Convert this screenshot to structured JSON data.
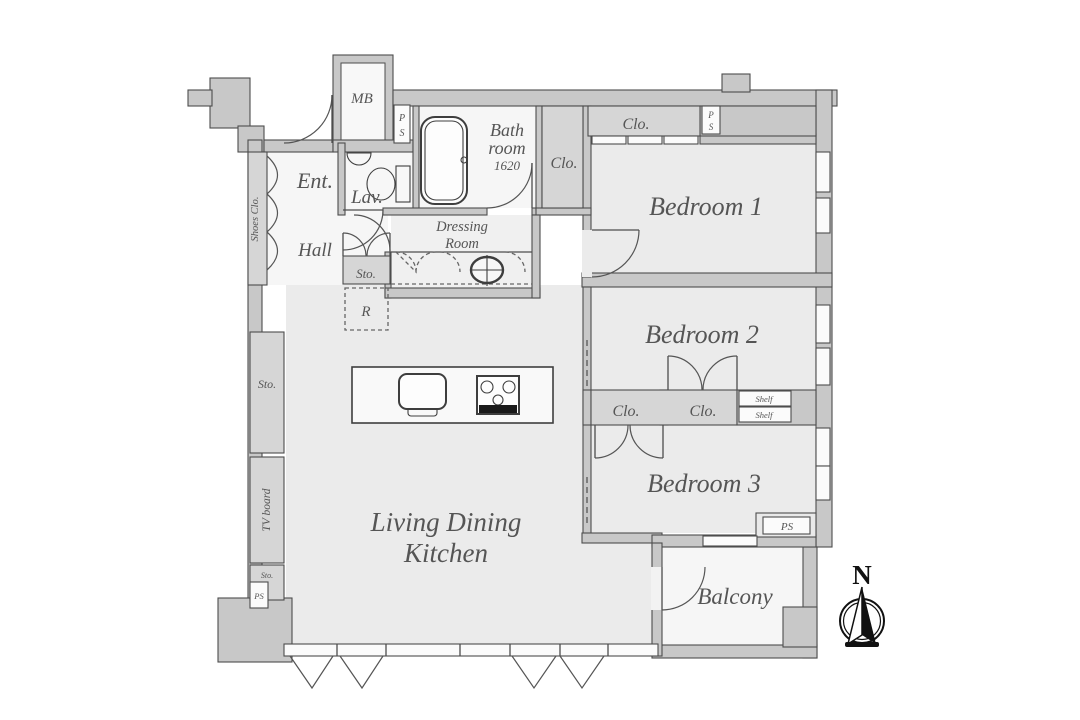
{
  "rooms": {
    "entrance": "Ent.",
    "hall": "Hall",
    "lavatory": "Lav.",
    "bathroom_line1": "Bath",
    "bathroom_line2": "room",
    "bathroom_size": "1620",
    "dressing_line1": "Dressing",
    "dressing_line2": "Room",
    "bedroom1": "Bedroom 1",
    "bedroom2": "Bedroom 2",
    "bedroom3": "Bedroom 3",
    "ldk_line1": "Living Dining",
    "ldk_line2": "Kitchen",
    "balcony": "Balcony"
  },
  "fixtures": {
    "meter_box": "MB",
    "shoes_closet": "Shoes Clo.",
    "closet": "Clo.",
    "storage": "Sto.",
    "shelf": "Shelf",
    "tv_board": "TV board",
    "refrigerator": "R",
    "pipe_shaft": "PS",
    "pipe_shaft_p": "P",
    "pipe_shaft_s": "S"
  },
  "compass": {
    "north": "N"
  },
  "colors": {
    "wall_fill": "#c8c8c8",
    "closet_fill": "#d6d6d6",
    "floor_fill": "#ebebeb",
    "line": "#4d4d4d",
    "text": "#555555"
  }
}
